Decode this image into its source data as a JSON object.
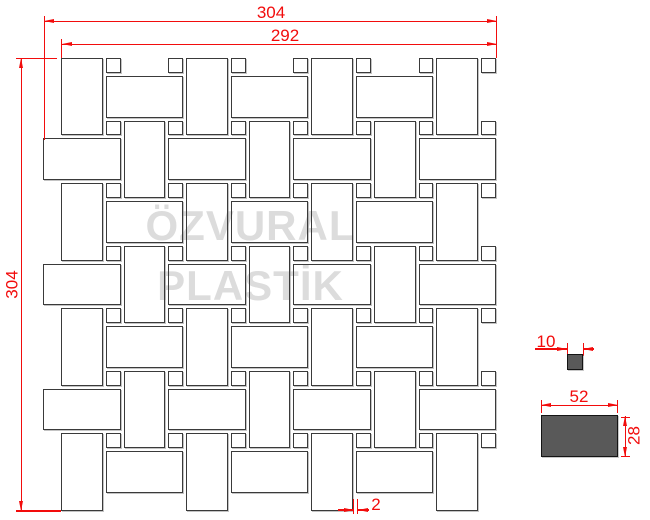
{
  "drawing": {
    "watermark": {
      "line1": "ÖZVURAL",
      "line2": "PLASTİK"
    },
    "dimensions": {
      "overall_width": "304",
      "inner_width": "292",
      "overall_height": "304",
      "joint_gap": "2",
      "dot_size": "10",
      "chip_width": "52",
      "chip_height": "28"
    },
    "colors": {
      "dimension_red": "#f20c0c",
      "tile_stroke": "#3a3a3a",
      "solid_fill": "#595959",
      "watermark_gray": "#dcdcdc"
    },
    "mosaic": {
      "scale": 1.49,
      "origin_x": 61,
      "origin_y": 58,
      "vtile": {
        "w": 28,
        "h": 52
      },
      "htile": {
        "w": 52,
        "h": 28
      },
      "dot": {
        "w": 10,
        "h": 10
      },
      "vtiles_even": {
        "xs": [
          0,
          84,
          168,
          252
        ],
        "ys": [
          0,
          84,
          168,
          252
        ]
      },
      "vtiles_odd": {
        "xs": [
          42,
          126,
          210
        ],
        "ys": [
          42,
          126,
          210
        ]
      },
      "htiles_even": {
        "xs": [
          30,
          114,
          198
        ],
        "ys": [
          12,
          96,
          180,
          264
        ]
      },
      "htiles_odd": {
        "xs": [
          -12,
          72,
          156,
          240
        ],
        "ys": [
          54,
          138,
          222
        ]
      },
      "dots": {
        "xs": [
          30,
          72,
          114,
          156,
          198,
          240,
          282
        ],
        "ys": [
          0,
          42,
          84,
          126,
          168,
          210,
          252
        ]
      }
    }
  }
}
